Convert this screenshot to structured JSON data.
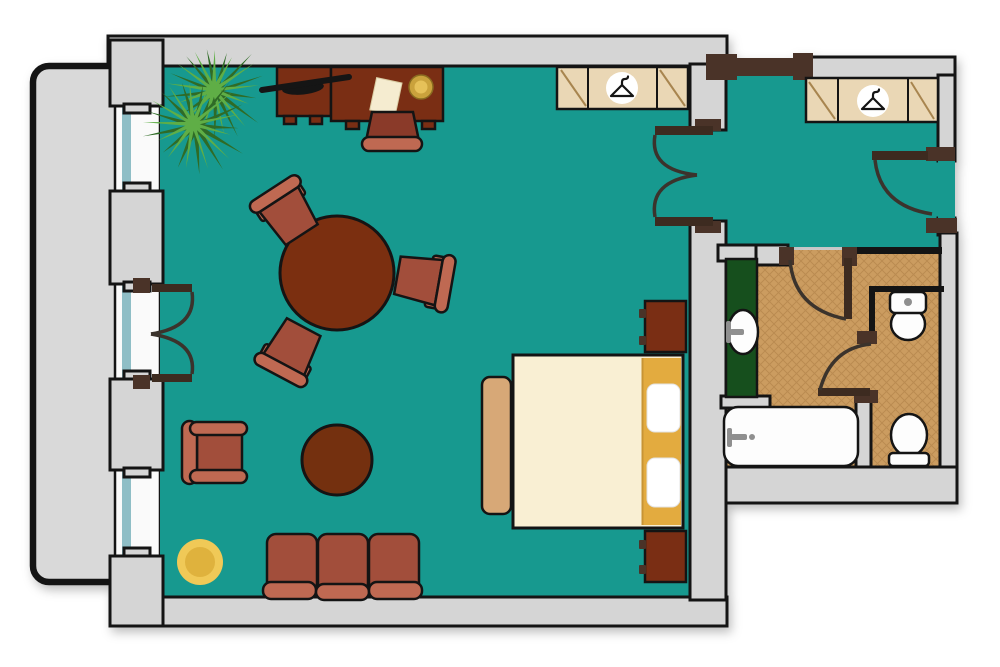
{
  "canvas": {
    "width": 1000,
    "height": 667,
    "background": "#ffffff"
  },
  "palette": {
    "floor_teal": "#17998f",
    "wall_gray": "#d5d5d5",
    "balcony_gray": "#d9d9d9",
    "wall_line": "#141414",
    "door_dark": "#4a3328",
    "leaf_dark": "#3d2b20",
    "arc_dark": "#3b332c",
    "window_white": "#fafafa",
    "window_glass": "#8fbec6",
    "closet_tan": "#ead7b5",
    "closet_line": "#a8854f",
    "wood_dark": "#7a2e14",
    "chair_seat": "#a24e3b",
    "desk_chair_seat": "#8a3a29",
    "chair_bar": "#bf6952",
    "table_brown": "#7b2f10",
    "ottoman_brown": "#74300f",
    "bed_cream": "#f9efd3",
    "bed_gold": "#e3ab3f",
    "bed_gold_edge": "#c89435",
    "bench_tan": "#d7a877",
    "pillow_white": "#ffffff",
    "rug_outer": "#f0c957",
    "rug_inner": "#dfb23d",
    "plant_dark": "#2f6b26",
    "plant_light": "#5fae46",
    "tile_base": "#cb9c60",
    "tile_line": "#b18247",
    "vanity_green": "#164f1d",
    "fixture_white": "#fdfdfd",
    "metal_gray": "#8f8f8f",
    "lamp_black": "#151515",
    "paper_cream": "#f5ecd0",
    "plate_gold": "#caa23c",
    "plate_gold_light": "#e6c159"
  },
  "plan": {
    "type": "hotel-suite-floor-plan",
    "rooms": [
      {
        "id": "living-bedroom",
        "furniture": [
          "palm-plant",
          "dresser",
          "desk",
          "desk-lamp",
          "paper-sheet",
          "gold-plate",
          "desk-chair",
          "wardrobe-with-hanger",
          "round-dining-table",
          "dining-chair",
          "dining-chair",
          "dining-chair",
          "armchair",
          "round-ottoman",
          "round-rug",
          "sofa",
          "double-bed",
          "pillow",
          "pillow",
          "bed-bench",
          "nightstand",
          "nightstand"
        ]
      },
      {
        "id": "hallway",
        "furniture": [
          "wardrobe-with-hanger"
        ]
      },
      {
        "id": "bathroom",
        "furniture": [
          "vanity-counter",
          "sink",
          "bathtub"
        ]
      },
      {
        "id": "water-closet",
        "furniture": [
          "toilet",
          "toilet"
        ]
      },
      {
        "id": "balcony",
        "furniture": []
      }
    ],
    "openings": [
      "balcony-double-door",
      "bedroom-double-door",
      "bathroom-door",
      "water-closet-door",
      "entry-door"
    ],
    "windows": 2
  },
  "icons": {
    "hanger": "clothes-hanger-icon"
  }
}
